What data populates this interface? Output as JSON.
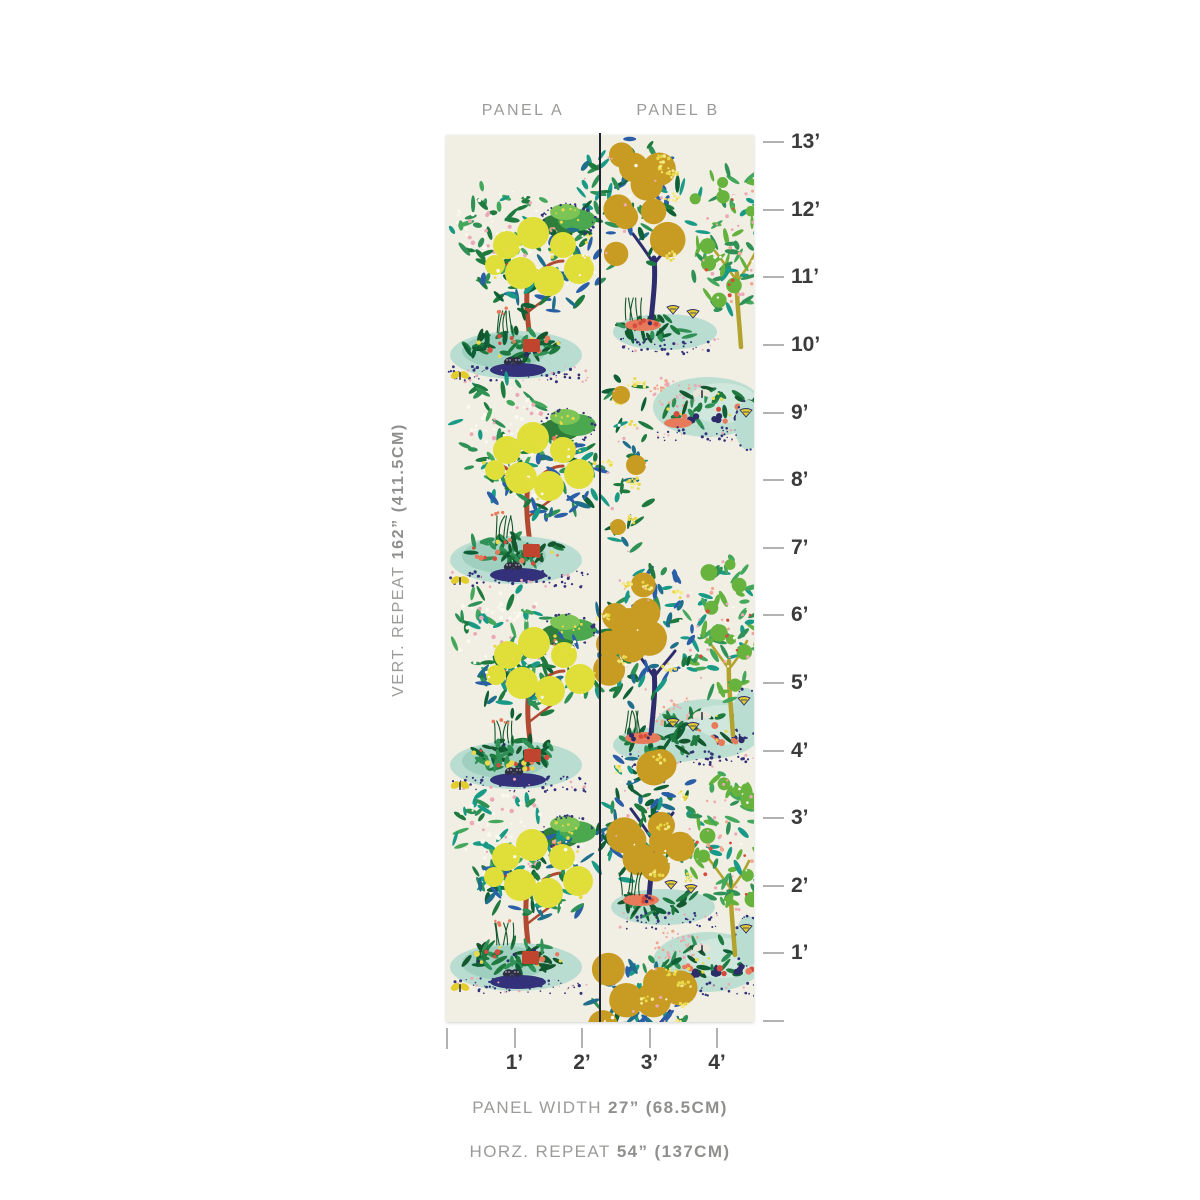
{
  "labels": {
    "panel_a": "PANEL A",
    "panel_b": "PANEL B"
  },
  "captions": {
    "vert_repeat": {
      "prefix": "VERT. REPEAT",
      "value": "162” (411.5CM)"
    },
    "panel_width": {
      "prefix": "PANEL WIDTH",
      "value": "27” (68.5CM)"
    },
    "horz_repeat": {
      "prefix": "HORZ. REPEAT",
      "value": "54” (137CM)"
    }
  },
  "rulers": {
    "vertical": {
      "unit": "feet",
      "labels": [
        "13’",
        "12’",
        "11’",
        "10’",
        "9’",
        "8’",
        "7’",
        "6’",
        "5’",
        "4’",
        "3’",
        "2’",
        "1’"
      ]
    },
    "horizontal": {
      "unit": "feet",
      "labels": [
        "1’",
        "2’",
        "3’",
        "4’"
      ]
    }
  },
  "colors": {
    "page_bg": "#ffffff",
    "panel_cream": "#f1eee3",
    "divider": "#23232f",
    "tick": "#b2b2b0",
    "ruler_text": "#3b3b3b",
    "caption_text": "#9b9b99",
    "lemon": "#e0df3a",
    "gold": "#c89c22",
    "lime": "#67b33e",
    "trunk_red": "#b04a30",
    "trunk_navy": "#2d2d6e",
    "trunk_olive": "#b2a32e",
    "teal_light": "#b9ddd1",
    "teal_mid": "#9fd0bf",
    "speckle_navy": "#32317a",
    "coral": "#e87a5c",
    "red": "#d64b3c",
    "salmon": "#f2a58f",
    "pink": "#eba9b8",
    "white_blossom": "#fbf8ee",
    "yellow_dot": "#e9d84a",
    "berry": "#2c2c68",
    "butterfly_yellow": "#e2cd2d",
    "butterfly_black": "#2e2e44",
    "pot_terracotta": "#c0452e",
    "grass": "#14572e",
    "greens_tree": [
      "#1e7a3e",
      "#2f9155",
      "#0f6036",
      "#2a5fa8",
      "#199a86",
      "#1f6e8c"
    ],
    "greens_bush": [
      "#2f9155",
      "#43a85c",
      "#1e7a3e",
      "#199a86"
    ],
    "greens_garden": [
      "#14572e",
      "#1e7a3e",
      "#2f9155",
      "#0f6036"
    ],
    "greens_lime": [
      "#43a85c",
      "#63b23e",
      "#2f9155",
      "#199a86"
    ]
  },
  "wallpaper": {
    "panel_width_px": 308,
    "panel_height_px": 887,
    "divider_x": 154,
    "panel_a_clusters": [
      {
        "x": 85,
        "y": 250
      },
      {
        "x": 85,
        "y": 455
      },
      {
        "x": 86,
        "y": 660
      },
      {
        "x": 84,
        "y": 862
      }
    ],
    "panel_b": {
      "orange_trees": [
        {
          "base": [
            205,
            187
          ],
          "foliage": [
            183,
            70,
            56,
            66
          ]
        },
        {
          "base": [
            205,
            600
          ],
          "foliage": [
            197,
            498,
            50,
            76
          ]
        },
        {
          "base": [
            203,
            762
          ],
          "foliage": [
            200,
            682,
            52,
            70
          ]
        },
        {
          "base": [
            200,
            960
          ],
          "foliage": [
            195,
            878,
            55,
            58
          ]
        }
      ],
      "lime_trees": [
        [
          295,
          212
        ],
        [
          287,
          600
        ],
        [
          289,
          820
        ]
      ],
      "garden_beds": [
        272,
        594,
        827
      ],
      "vases": [
        [
          302,
          290
        ],
        [
          300,
          578
        ],
        [
          302,
          806
        ]
      ],
      "blossom_column": [
        180,
        330
      ]
    }
  },
  "ruler_geometry": {
    "v_ruler_x": 763,
    "v_zero_y": 1021,
    "px_per_foot": 67.6,
    "h_ruler_y": 1028,
    "h_zero_x": 447,
    "h_px_per_foot": 67.5
  }
}
